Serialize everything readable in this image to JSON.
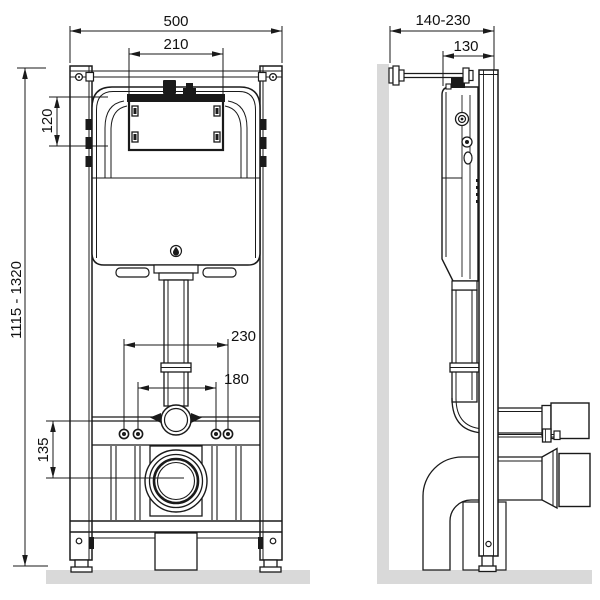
{
  "title": "Wall-hung WC installation frame with concealed cistern — dimensioned technical drawing",
  "views": {
    "front": {
      "name": "front-view"
    },
    "side": {
      "name": "side-view"
    }
  },
  "dimensions": {
    "front": {
      "frame_width": "500",
      "plate_opening_width": "210",
      "plate_opening_height": "120",
      "frame_height_range": "1115 - 1320",
      "fixing_spacing_outer": "230",
      "fixing_spacing_inner": "180",
      "outlet_offset": "135"
    },
    "side": {
      "depth_range": "140-230",
      "cistern_depth": "130"
    }
  },
  "icons": {
    "brand_drop_icon": "water-drop mark on cistern"
  },
  "colors": {
    "line": "#1a1a1a",
    "surface_gray": "#d9d9d9",
    "background": "#ffffff"
  }
}
